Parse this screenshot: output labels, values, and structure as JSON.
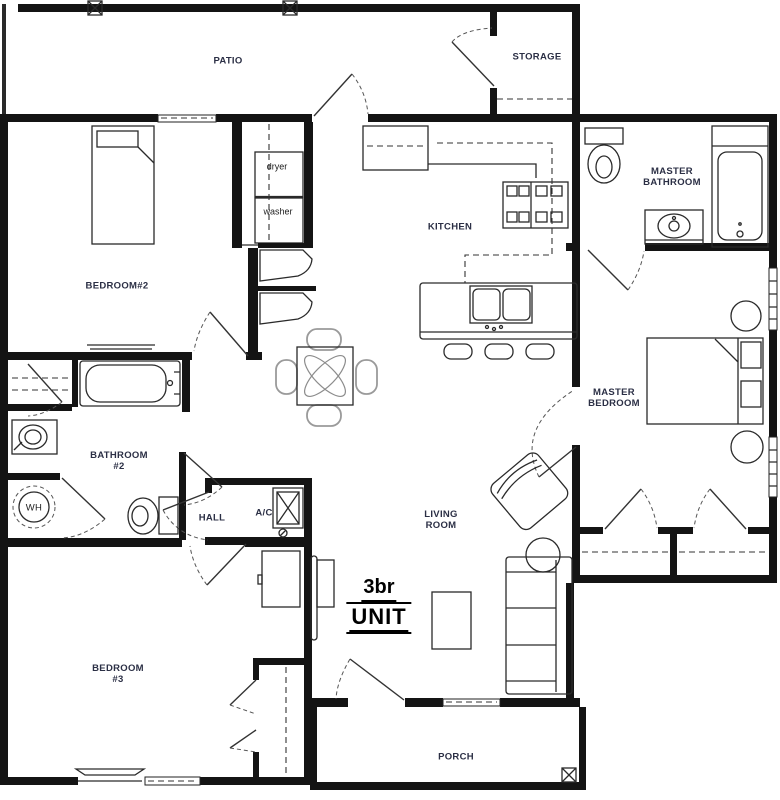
{
  "plan": {
    "labels": {
      "patio": "PATIO",
      "storage": "STORAGE",
      "dryer": "dryer",
      "washer": "washer",
      "bedroom2": "BEDROOM#2",
      "kitchen": "KITCHEN",
      "master_bathroom": {
        "l1": "MASTER",
        "l2": "BATHROOM"
      },
      "master_bedroom": {
        "l1": "MASTER",
        "l2": "BEDROOM"
      },
      "bathroom2": {
        "l1": "BATHROOM",
        "l2": "#2"
      },
      "wh": "WH",
      "hall": "HALL",
      "ac": "A/C",
      "living_room": {
        "l1": "LIVING",
        "l2": "ROOM"
      },
      "unit_title": {
        "l1": "3br",
        "l2": "UNIT"
      },
      "bedroom3": {
        "l1": "BEDROOM",
        "l2": "#3"
      },
      "porch": "PORCH"
    },
    "colors": {
      "walls": "#141414",
      "room_label": "#2b2f45",
      "title": "#000000",
      "furniture_line": "#2a2a2a"
    }
  }
}
